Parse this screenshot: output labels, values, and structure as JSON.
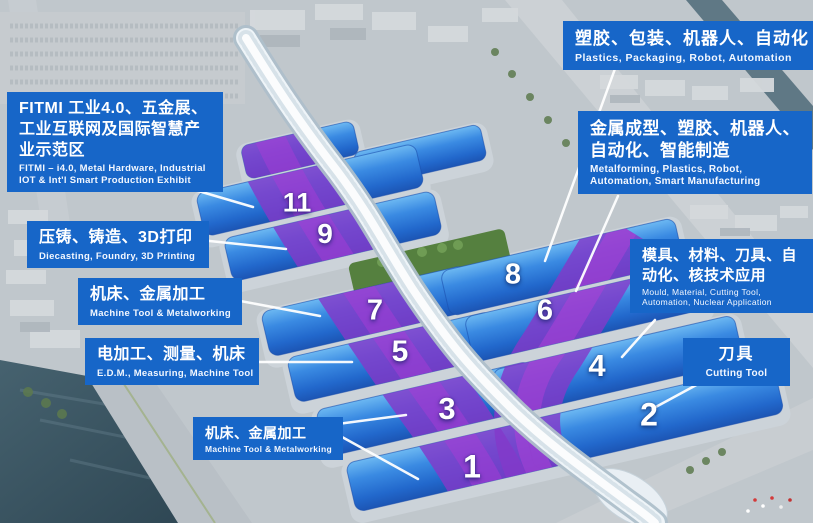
{
  "colors": {
    "label_bg": "#1766c8",
    "hall_blue": "#2e7cd8",
    "stripe_purple": "#8a3cce",
    "leader_line": "#ffffff",
    "number_text": "#ffffff"
  },
  "halls": [
    {
      "number": "11"
    },
    {
      "number": "9"
    },
    {
      "number": "8"
    },
    {
      "number": "7"
    },
    {
      "number": "6"
    },
    {
      "number": "5"
    },
    {
      "number": "4"
    },
    {
      "number": "3"
    },
    {
      "number": "2"
    },
    {
      "number": "1"
    }
  ],
  "labels": {
    "fitmi": {
      "zh": "FITMI 工业4.0、五金展、工业互联网及国际智慧产业示范区",
      "en": "FITMI – i4.0, Metal Hardware, Industrial IOT & Int'l Smart Production Exhibit"
    },
    "diecasting": {
      "zh": "压铸、铸造、3D打印",
      "en": "Diecasting, Foundry, 3D Printing"
    },
    "machine_tool_upper": {
      "zh": "机床、金属加工",
      "en": "Machine Tool & Metalworking"
    },
    "edm": {
      "zh": "电加工、测量、机床",
      "en": "E.D.M., Measuring, Machine Tool"
    },
    "machine_tool_lower": {
      "zh": "机床、金属加工",
      "en": "Machine Tool & Metalworking"
    },
    "plastics": {
      "zh": "塑胶、包装、机器人、自动化",
      "en": "Plastics, Packaging, Robot, Automation"
    },
    "metalforming": {
      "zh": "金属成型、塑胶、机器人、自动化、智能制造",
      "en": "Metalforming, Plastics, Robot, Automation, Smart Manufacturing"
    },
    "mould": {
      "zh": "模具、材料、刀具、自动化、核技术应用",
      "en": "Mould, Material, Cutting Tool, Automation, Nuclear Application"
    },
    "cutting_tool": {
      "zh": "刀具",
      "en": "Cutting Tool"
    }
  }
}
